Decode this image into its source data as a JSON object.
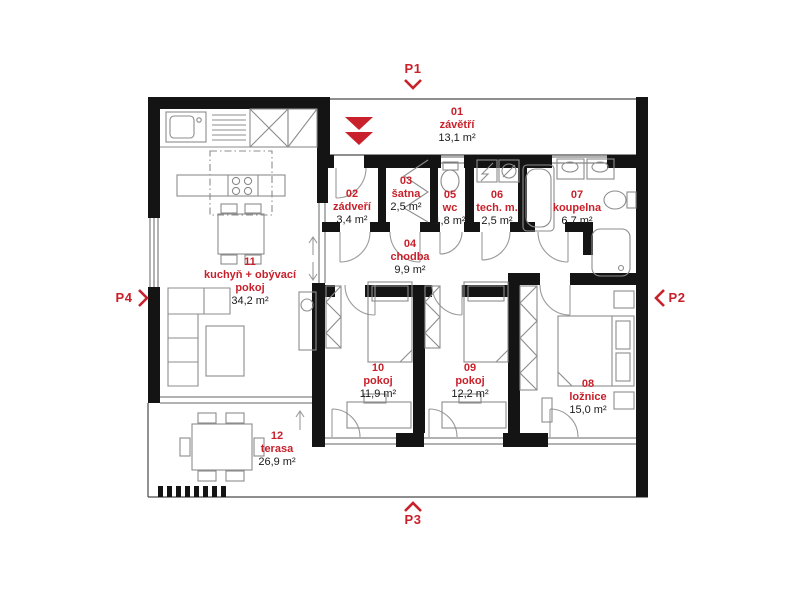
{
  "plan": {
    "type": "residential floor plan",
    "colors": {
      "accent_red": "#c8212b",
      "wall_black": "#141414",
      "furniture_gray": "#8c8c8c"
    },
    "rooms": [
      {
        "number": "01",
        "name": "závětří",
        "area": "13,1 m²"
      },
      {
        "number": "02",
        "name": "zádveří",
        "area": "3,4 m²"
      },
      {
        "number": "03",
        "name": "šatna",
        "area": "2,5 m²"
      },
      {
        "number": "04",
        "name": "chodba",
        "area": "9,9 m²"
      },
      {
        "number": "05",
        "name": "wc",
        "area": "1,8 m²"
      },
      {
        "number": "06",
        "name": "tech. m.",
        "area": "2,5 m²"
      },
      {
        "number": "07",
        "name": "koupelna",
        "area": "6,7 m²"
      },
      {
        "number": "08",
        "name": "ložnice",
        "area": "15,0 m²"
      },
      {
        "number": "09",
        "name": "pokoj",
        "area": "12,2 m²"
      },
      {
        "number": "10",
        "name": "pokoj",
        "area": "11,9 m²"
      },
      {
        "number": "11",
        "name": "kuchyň + obývací pokoj",
        "area": "34,2 m²"
      },
      {
        "number": "12",
        "name": "terasa",
        "area": "26,9 m²"
      }
    ],
    "markers": [
      {
        "label": "P1",
        "direction": "down"
      },
      {
        "label": "P2",
        "direction": "left"
      },
      {
        "label": "P3",
        "direction": "up"
      },
      {
        "label": "P4",
        "direction": "right"
      }
    ],
    "entrance_marker": {
      "type": "double-triangle-down",
      "color": "#c8212b"
    }
  }
}
